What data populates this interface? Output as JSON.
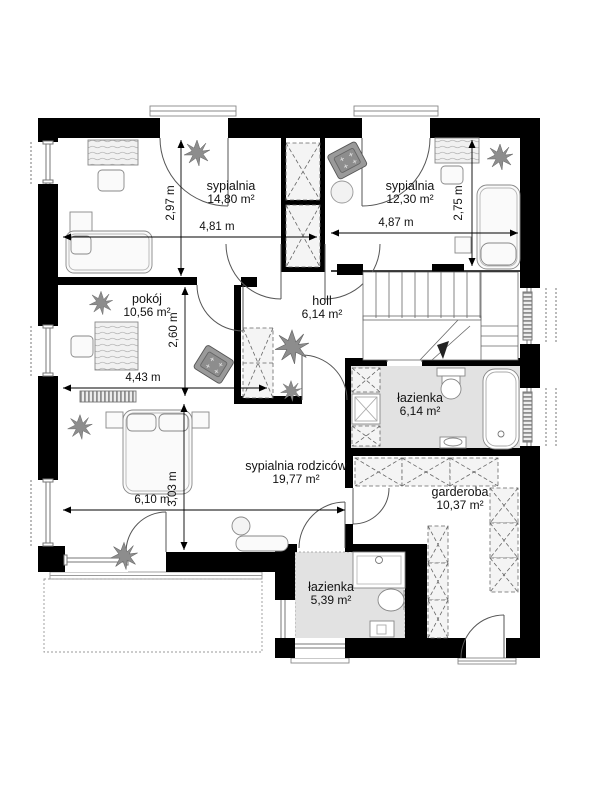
{
  "plan": {
    "type": "floor-plan",
    "floor": "architectural plan, upper floor"
  },
  "rooms": [
    {
      "name": "sypialnia",
      "area": "14,80 m²"
    },
    {
      "name": "sypialnia",
      "area": "12,30 m²"
    },
    {
      "name": "pokój",
      "area": "10,56 m²"
    },
    {
      "name": "holl",
      "area": "6,14 m²"
    },
    {
      "name": "łazienka",
      "area": "6,14 m²"
    },
    {
      "name": "sypialnia rodziców",
      "area": "19,77 m²"
    },
    {
      "name": "garderoba",
      "area": "10,37 m²"
    },
    {
      "name": "łazienka",
      "area": "5,39 m²"
    }
  ],
  "dimensions": [
    {
      "label": "2,97 m",
      "orientation": "vertical"
    },
    {
      "label": "4,81 m",
      "orientation": "horizontal"
    },
    {
      "label": "4,87 m",
      "orientation": "horizontal"
    },
    {
      "label": "2,75 m",
      "orientation": "vertical"
    },
    {
      "label": "2,60 m",
      "orientation": "vertical"
    },
    {
      "label": "4,43 m",
      "orientation": "horizontal"
    },
    {
      "label": "3,03 m",
      "orientation": "vertical"
    },
    {
      "label": "6,10 m",
      "orientation": "horizontal"
    }
  ],
  "colors": {
    "wall": "#000000",
    "bath_floor": "#e2e2e2",
    "furniture_dark": "#9a9a9a",
    "outline": "#888888"
  }
}
